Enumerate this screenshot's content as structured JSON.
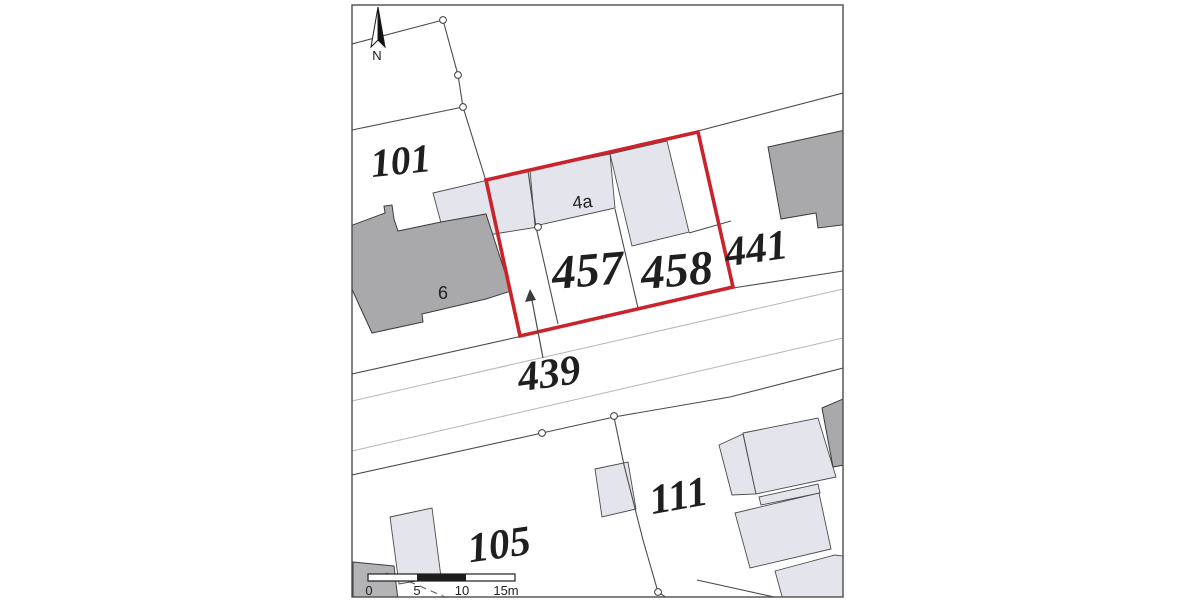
{
  "page": {
    "description": "Cadastral title plan extract with red-edged subject parcel"
  },
  "colors": {
    "map-border": "#4d4d4d",
    "boundary-line": "#4b4b4b",
    "road-line-light": "#b5b5b5",
    "red-boundary": "#c9232c",
    "building-light": "#e4e4ec",
    "building-dark": "#a9a9ab",
    "building-mid": "#b4b4b6",
    "label-text": "#1f1f1f",
    "marker-fill": "#ffffff",
    "page-bg": "#ffffff"
  },
  "north": {
    "label": "N",
    "icon": "north-arrow-icon"
  },
  "parcels": {
    "p101": "101",
    "p441": "441",
    "p439": "439",
    "p457": "457",
    "p458": "458",
    "p105": "105",
    "p111": "111"
  },
  "buildings": {
    "b4a": "4a",
    "b6": "6"
  },
  "scale_bar": {
    "tick0": "0",
    "tick5": "5",
    "tick10": "10",
    "tick15": "15m"
  }
}
